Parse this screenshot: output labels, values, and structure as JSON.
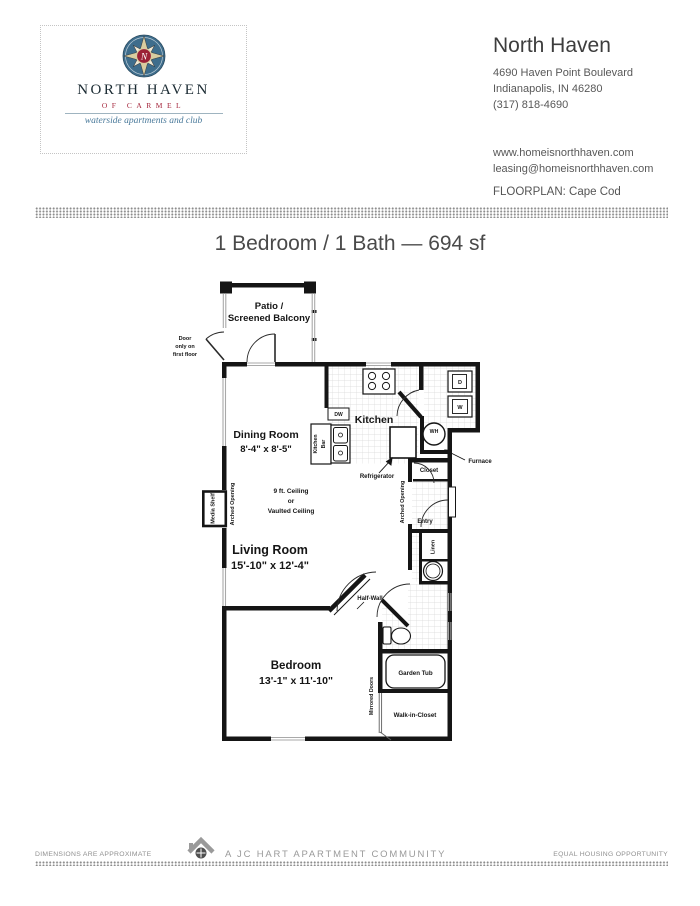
{
  "header": {
    "logo": {
      "name": "NORTH HAVEN",
      "subtitle": "OF CARMEL",
      "tagline": "waterside apartments and club",
      "monogram": "N"
    },
    "contact": {
      "name": "North Haven",
      "address_line1": "4690 Haven Point Boulevard",
      "address_line2": "Indianapolis, IN 46280",
      "phone": "(317) 818-4690",
      "website": "www.homeisnorthhaven.com",
      "email": "leasing@homeisnorthhaven.com"
    },
    "floorplan_label": "FLOORPLAN: Cape Cod"
  },
  "title": "1 Bedroom / 1 Bath — 694 sf",
  "plan": {
    "patio1": "Patio /",
    "patio2": "Screened Balcony",
    "door_note": [
      "Door",
      "only on",
      "first floor"
    ],
    "dining": "Dining Room",
    "dining_dim": "8'-4\" x 8'-5\"",
    "kitchen": "Kitchen",
    "kitchen_bar": [
      "Kitchen",
      "Bar"
    ],
    "dw": "DW",
    "dryer": "D",
    "washer": "W",
    "water_heater": "WH",
    "refrigerator": "Refrigerator",
    "furnace": "Furnace",
    "closet": "Closet",
    "entry": "Entry",
    "linen": "Linen",
    "arched_opening": "Arched Opening",
    "media_shelf": "Media Shelf",
    "ceiling": [
      "9 ft. Ceiling",
      "or",
      "Vaulted Ceiling"
    ],
    "living": "Living Room",
    "living_dim": "15'-10\" x 12'-4\"",
    "half_wall": "Half-Wall",
    "bedroom": "Bedroom",
    "bedroom_dim": "13'-1\" x 11'-10\"",
    "garden_tub": "Garden Tub",
    "walk_in_closet": "Walk-in-Closet",
    "mirrored_doors": "Mirrored Doors"
  },
  "footer": {
    "left": "DIMENSIONS ARE APPROXIMATE",
    "center": "A JC HART APARTMENT COMMUNITY",
    "right": "EQUAL HOUSING OPPORTUNITY"
  },
  "colors": {
    "logo_blue": "#3e6d8c",
    "logo_red": "#9c2136",
    "logo_cream": "#d9cda0",
    "tagline_blue": "#4a7a9b",
    "wall_black": "#151515",
    "muted_gray": "#8f8f8f"
  },
  "icons": {
    "logo": "compass-rose-icon",
    "footer": "house-icon"
  }
}
